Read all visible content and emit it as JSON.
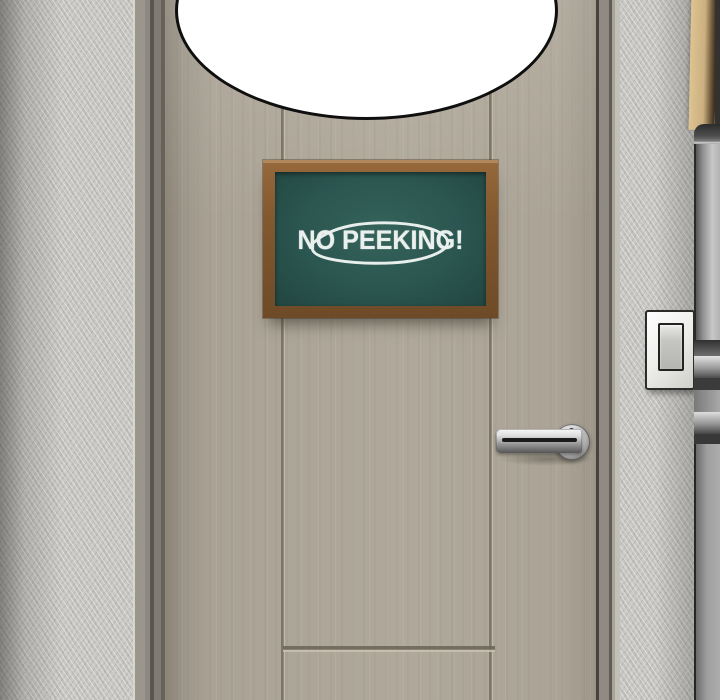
{
  "panel": {
    "sign": {
      "text": "NO PEEKING!",
      "board_color": "#2b5550",
      "frame_color": "#7c5530",
      "chalk_color": "#eaf0ed"
    },
    "objects": {
      "speech_bubble": "empty speech bubble (cropped at top)",
      "door": "beige paneled door",
      "door_handle": "chrome lever handle",
      "light_switch": "wall light switch",
      "broom_handle": "wooden broom handle",
      "appliance": "metal appliance edge"
    },
    "colors": {
      "wall": "#c9c8c5",
      "door": "#aba496",
      "door_frame": "#8d8880",
      "handle_chrome": "#c6c6c6",
      "bubble_fill": "#ffffff",
      "bubble_outline": "#0f0f0f"
    }
  }
}
